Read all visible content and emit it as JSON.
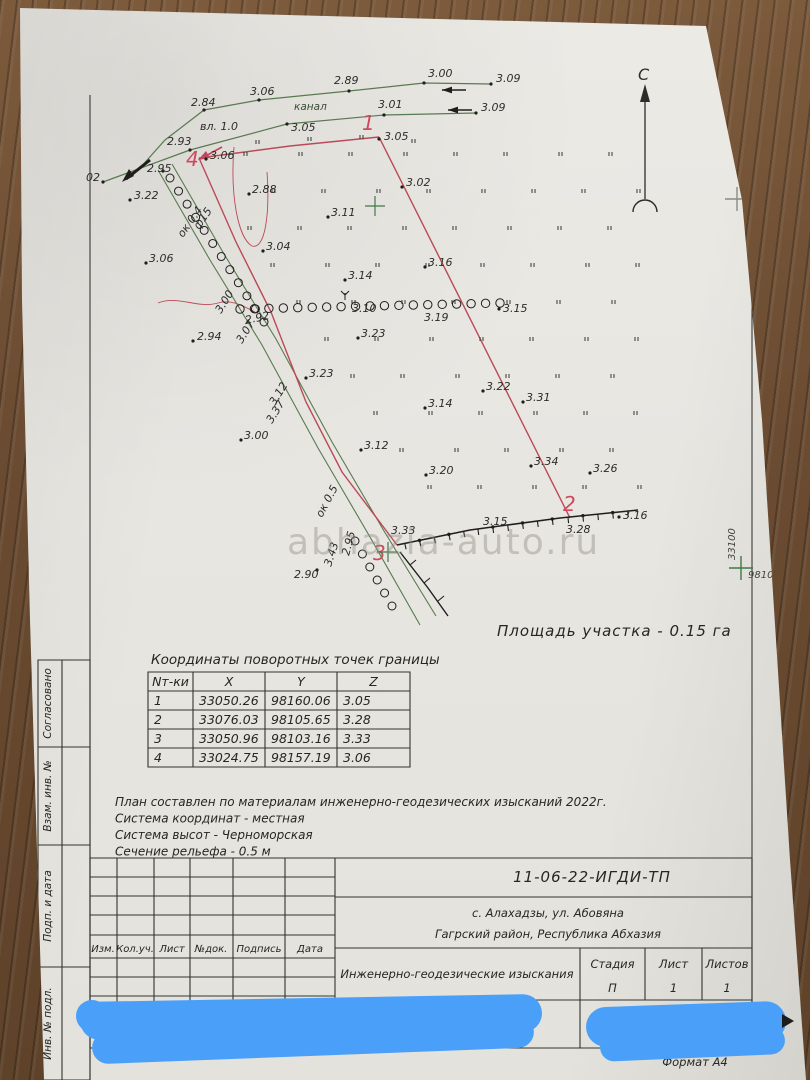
{
  "paper": {
    "watermark": "abhazia-auto.ru",
    "area_label": "Площадь участка - 0.15 га",
    "format_label": "Формат А4"
  },
  "compass": {
    "north_label": "С"
  },
  "grid_marks": {
    "northing": "33100",
    "easting": "98100"
  },
  "map": {
    "canal_label": "канал",
    "boundary_numbers": [
      {
        "n": "1",
        "x": 362,
        "y": 130
      },
      {
        "n": "2",
        "x": 563,
        "y": 511
      },
      {
        "n": "3",
        "x": 373,
        "y": 560
      },
      {
        "n": "4",
        "x": 186,
        "y": 166
      }
    ],
    "labels": [
      {
        "t": "2.84",
        "x": 191,
        "y": 106
      },
      {
        "t": "3.06",
        "x": 250,
        "y": 95
      },
      {
        "t": "2.89",
        "x": 334,
        "y": 84
      },
      {
        "t": "3.00",
        "x": 428,
        "y": 77
      },
      {
        "t": "3.09",
        "x": 496,
        "y": 82
      },
      {
        "t": "3.01",
        "x": 378,
        "y": 108
      },
      {
        "t": "3.09",
        "x": 481,
        "y": 111
      },
      {
        "t": "вл. 1.0",
        "x": 200,
        "y": 130
      },
      {
        "t": "3.05",
        "x": 291,
        "y": 131
      },
      {
        "t": "3.05",
        "x": 384,
        "y": 140
      },
      {
        "t": "2.93",
        "x": 167,
        "y": 145
      },
      {
        "t": "3.06",
        "x": 210,
        "y": 159
      },
      {
        "t": "2.95",
        "x": 147,
        "y": 172
      },
      {
        "t": "02",
        "x": 86,
        "y": 181
      },
      {
        "t": "3.22",
        "x": 134,
        "y": 199
      },
      {
        "t": "2.88",
        "x": 252,
        "y": 193
      },
      {
        "t": "3.02",
        "x": 406,
        "y": 186
      },
      {
        "t": "3.11",
        "x": 331,
        "y": 216
      },
      {
        "t": "3.04",
        "x": 266,
        "y": 250
      },
      {
        "t": "3.06",
        "x": 149,
        "y": 262
      },
      {
        "t": "3.14",
        "x": 348,
        "y": 279
      },
      {
        "t": "3.16",
        "x": 428,
        "y": 266
      },
      {
        "t": "3.10",
        "x": 352,
        "y": 312
      },
      {
        "t": "3.19",
        "x": 424,
        "y": 321
      },
      {
        "t": "3.15",
        "x": 503,
        "y": 312
      },
      {
        "t": "2.92",
        "x": 246,
        "y": 324,
        "r": -12
      },
      {
        "t": "2.94",
        "x": 197,
        "y": 340
      },
      {
        "t": "3.23",
        "x": 361,
        "y": 337
      },
      {
        "t": "3.00",
        "x": 221,
        "y": 314,
        "r": -58
      },
      {
        "t": "3.07",
        "x": 242,
        "y": 344,
        "r": -58
      },
      {
        "t": "3.23",
        "x": 309,
        "y": 377
      },
      {
        "t": "3.22",
        "x": 486,
        "y": 390
      },
      {
        "t": "3.14",
        "x": 428,
        "y": 407
      },
      {
        "t": "3.31",
        "x": 526,
        "y": 401
      },
      {
        "t": "3.12",
        "x": 275,
        "y": 406,
        "r": -58
      },
      {
        "t": "3.37",
        "x": 272,
        "y": 424,
        "r": -58
      },
      {
        "t": "3.12",
        "x": 364,
        "y": 449
      },
      {
        "t": "3.00",
        "x": 244,
        "y": 439
      },
      {
        "t": "3.20",
        "x": 429,
        "y": 474
      },
      {
        "t": "3.34",
        "x": 534,
        "y": 465
      },
      {
        "t": "3.26",
        "x": 593,
        "y": 472
      },
      {
        "t": "ок 0.5",
        "x": 322,
        "y": 518,
        "r": -62
      },
      {
        "t": "ок 0.4",
        "x": 183,
        "y": 238,
        "r": -55
      },
      {
        "t": "ф15",
        "x": 199,
        "y": 230,
        "r": -55
      },
      {
        "t": "3.33",
        "x": 391,
        "y": 534
      },
      {
        "t": "3.15",
        "x": 483,
        "y": 525
      },
      {
        "t": "3.28",
        "x": 566,
        "y": 533
      },
      {
        "t": "3.16",
        "x": 623,
        "y": 519
      },
      {
        "t": "2.95",
        "x": 349,
        "y": 556,
        "r": -75
      },
      {
        "t": "3.43",
        "x": 331,
        "y": 567,
        "r": -72
      },
      {
        "t": "2.90",
        "x": 294,
        "y": 578
      }
    ],
    "dots": [
      [
        204,
        110
      ],
      [
        259,
        100
      ],
      [
        349,
        91
      ],
      [
        424,
        83
      ],
      [
        491,
        84
      ],
      [
        384,
        115
      ],
      [
        476,
        113
      ],
      [
        287,
        124
      ],
      [
        379,
        139
      ],
      [
        190,
        150
      ],
      [
        206,
        159
      ],
      [
        163,
        171
      ],
      [
        103,
        182
      ],
      [
        130,
        200
      ],
      [
        249,
        194
      ],
      [
        402,
        187
      ],
      [
        328,
        217
      ],
      [
        263,
        251
      ],
      [
        146,
        263
      ],
      [
        345,
        280
      ],
      [
        425,
        267
      ],
      [
        499,
        309
      ],
      [
        193,
        341
      ],
      [
        358,
        338
      ],
      [
        306,
        378
      ],
      [
        483,
        391
      ],
      [
        425,
        408
      ],
      [
        523,
        402
      ],
      [
        361,
        450
      ],
      [
        241,
        440
      ],
      [
        426,
        475
      ],
      [
        531,
        466
      ],
      [
        590,
        473
      ],
      [
        619,
        517
      ],
      [
        317,
        570
      ]
    ]
  },
  "coords_table": {
    "title": "Координаты поворотных точек границы",
    "headers": [
      "Nт-ки",
      "X",
      "Y",
      "Z"
    ],
    "rows": [
      [
        "1",
        "33050.26",
        "98160.06",
        "3.05"
      ],
      [
        "2",
        "33076.03",
        "98105.65",
        "3.28"
      ],
      [
        "3",
        "33050.96",
        "98103.16",
        "3.33"
      ],
      [
        "4",
        "33024.75",
        "98157.19",
        "3.06"
      ]
    ]
  },
  "notes": [
    "План составлен по материалам инженерно-геодезических изысканий 2022г.",
    "Система координат -  местная",
    "Система высот - Черноморская",
    "Сечение рельефа - 0.5 м"
  ],
  "title_block": {
    "doc_code": "11-06-22-ИГДИ-ТП",
    "address_line1": "с. Алахадзы, ул. Абовяна",
    "address_line2": "Гагрский район, Республика Абхазия",
    "survey_type": "Инженерно-геодезические изыскания",
    "doc_type_line1": "Топографический план",
    "doc_type_line2": "М 1:500",
    "stage_headers": [
      "Стадия",
      "Лист",
      "Листов"
    ],
    "stage_values": [
      "П",
      "1",
      "1"
    ],
    "revision_headers": [
      "Изм.",
      "Кол.уч.",
      "Лист",
      "№док.",
      "Подпись",
      "Дата"
    ]
  },
  "sidebar": {
    "items": [
      "Согласовано",
      "Взам. инв. №",
      "Подп. и дата",
      "Инв. № подл."
    ]
  },
  "colors": {
    "boundary_red": "#bb4a58",
    "canal_green": "#587a50",
    "cross_green": "#3f7a46",
    "censor_blue": "#4aa0f8",
    "ink": "#2c2c2a"
  }
}
